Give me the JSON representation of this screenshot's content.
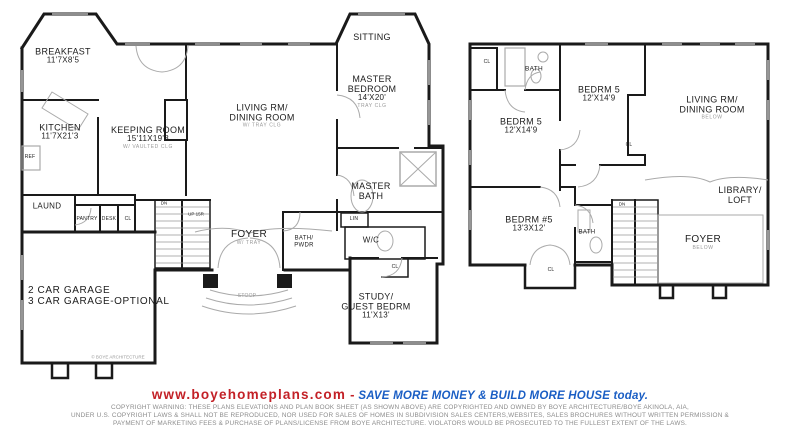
{
  "footer": {
    "website": "www.boyehomeplans.com",
    "separator": "-",
    "tagline": "SAVE MORE MONEY & BUILD MORE HOUSE today.",
    "copyright1": "COPYRIGHT WARNING: THESE PLANS ELEVATIONS AND PLAN BOOK SHEET (AS SHOWN ABOVE) ARE COPYRIGHTED AND OWNED BY BOYE ARCHITECTURE/BOYE AKINOLA, AIA,",
    "copyright2": "UNDER U.S. COPYRIGHT LAWS & SHALL NOT BE REPRODUCED, NOR USED FOR SALES OF HOMES IN SUBDIVISION SALES CENTERS,WEBSITES, SALES BROCHURES WITHOUT WRITTEN PERMISSION &",
    "copyright3": "PAYMENT OF MARKETING FEES & PURCHASE OF  PLANS/LICENSE FROM  BOYE ARCHITECTURE.  VIOLATORS  WOULD BE PROSECUTED TO THE FULLEST EXTENT OF  THE LAWS."
  },
  "colors": {
    "website_red": "#c32127",
    "tagline_blue": "#1a5ec4",
    "copyright_gray": "#8c8c8c",
    "wall_black": "#1a1a1a",
    "detail_gray": "#9a9a9a"
  },
  "p1": {
    "breakfast_l1": "BREAKFAST",
    "breakfast_l2": "11'7X8'5",
    "kitchen_l1": "KITCHEN",
    "kitchen_l2": "11'7X21'3",
    "ref": "REF",
    "keeping_l1": "KEEPING ROOM",
    "keeping_l2": "15'11X19'8",
    "keeping_note": "W/ VAULTED CLG",
    "living_l1": "LIVING RM/",
    "living_l2": "DINING ROOM",
    "living_note": "W/ TRAY CLG",
    "sitting": "SITTING",
    "master_l1": "MASTER",
    "master_l2": "BEDROOM",
    "master_l3": "14'X20'",
    "master_note": "TRAY CLG",
    "mbath_l1": "MASTER",
    "mbath_l2": "BATH",
    "lin": "LIN",
    "foyer": "FOYER",
    "foyer_note": "W/ TRAY",
    "bathpwdr_l1": "BATH/",
    "bathpwdr_l2": "PWDR",
    "wc": "W/C",
    "study_l1": "STUDY/",
    "study_l2": "GUEST BEDRM",
    "study_l3": "11'X13'",
    "stoop": "STOOP",
    "laund": "LAUND",
    "pantry": "PANTRY",
    "desk": "DESK",
    "cl": "CL",
    "garage_l1": "2  CAR GARAGE",
    "garage_l2": "3  CAR GARAGE-OPTIONAL",
    "dn": "DN",
    "up": "UP 15R",
    "cl_study": "CL",
    "stamp": "© BOYE ARCHITECTURE"
  },
  "p2": {
    "cl_top": "CL",
    "bath_top": "BATH",
    "bedrm5a_l1": "BEDRM 5",
    "bedrm5a_l2": "12'X14'9",
    "bedrm5b_l1": "BEDRM 5",
    "bedrm5b_l2": "12'X14'9",
    "cl_mid": "CL",
    "living_l1": "LIVING RM/",
    "living_l2": "DINING ROOM",
    "living_note": "BELOW",
    "library_l1": "LIBRARY/",
    "library_l2": "LOFT",
    "bedrm5c_l1": "BEDRM #5",
    "bedrm5c_l2": "13'3X12'",
    "bath2": "BATH",
    "cl_bot": "CL",
    "dn": "DN",
    "foyer": "FOYER",
    "foyer_note": "BELOW"
  }
}
